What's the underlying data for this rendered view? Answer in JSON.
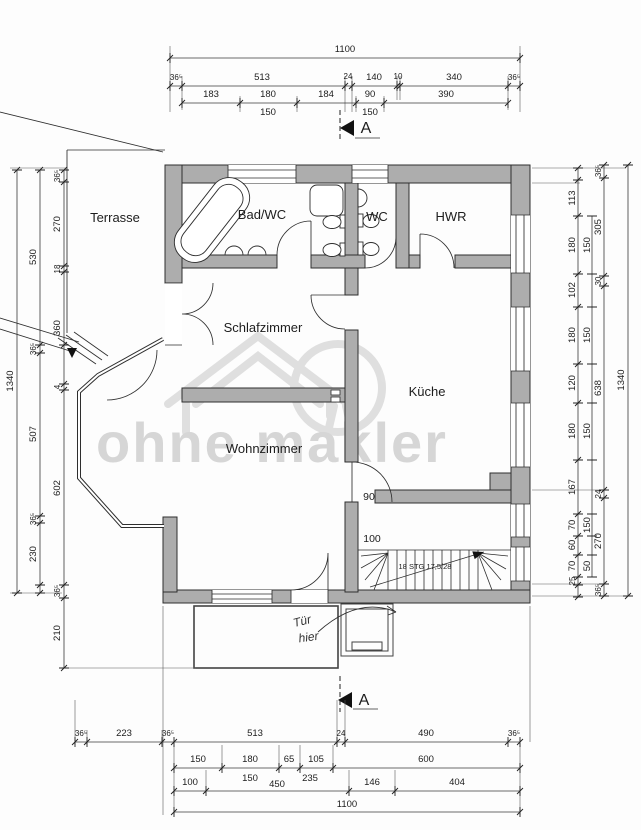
{
  "watermark": {
    "text": "ohne makler"
  },
  "rooms": {
    "terrasse": "Terrasse",
    "bad": "Bad/WC",
    "wc": "WC",
    "hwr": "HWR",
    "schlafzimmer": "Schlafzimmer",
    "kueche": "Küche",
    "wohnzimmer": "Wohnzimmer"
  },
  "stairs": {
    "label": "18 STG 17,5/28",
    "width": "100"
  },
  "doors": {
    "kueche_width": "90"
  },
  "marks": {
    "top": "A",
    "bottom": "A"
  },
  "note": {
    "line1": "Tür",
    "line2": "hier"
  },
  "dims": {
    "top": {
      "total": "1100",
      "row2": [
        "36⁵",
        "513",
        "24",
        "140",
        "10",
        "340",
        "36⁵"
      ],
      "row3": [
        "183",
        "180",
        "184",
        "90",
        "390"
      ],
      "row3b": [
        "150",
        "150"
      ]
    },
    "bottom": {
      "row1": [
        "36⁵",
        "223",
        "36⁵",
        "513",
        "24",
        "490",
        "36⁵"
      ],
      "row2": [
        "150",
        "180",
        "65",
        "105",
        "600"
      ],
      "row2b": [
        "150",
        "235"
      ],
      "row3": [
        "100",
        "450",
        "146",
        "404"
      ],
      "total": "1100"
    },
    "left": {
      "outer": "1340",
      "mid": [
        "530",
        "36⁵",
        "507",
        "36⁵",
        "230"
      ],
      "inner": [
        "36⁵",
        "270",
        "18",
        "360",
        "4",
        "602",
        "36⁵",
        "210"
      ]
    },
    "right": {
      "outer": "1340",
      "innerA": [
        "113",
        "180",
        "102",
        "180",
        "120",
        "180",
        "167",
        "70",
        "60",
        "70",
        "25"
      ],
      "mid": [
        "150",
        "150",
        "150",
        "150",
        "50"
      ],
      "outerC": [
        "36⁵",
        "305",
        "30",
        "638",
        "24",
        "270",
        "36⁵"
      ]
    }
  }
}
